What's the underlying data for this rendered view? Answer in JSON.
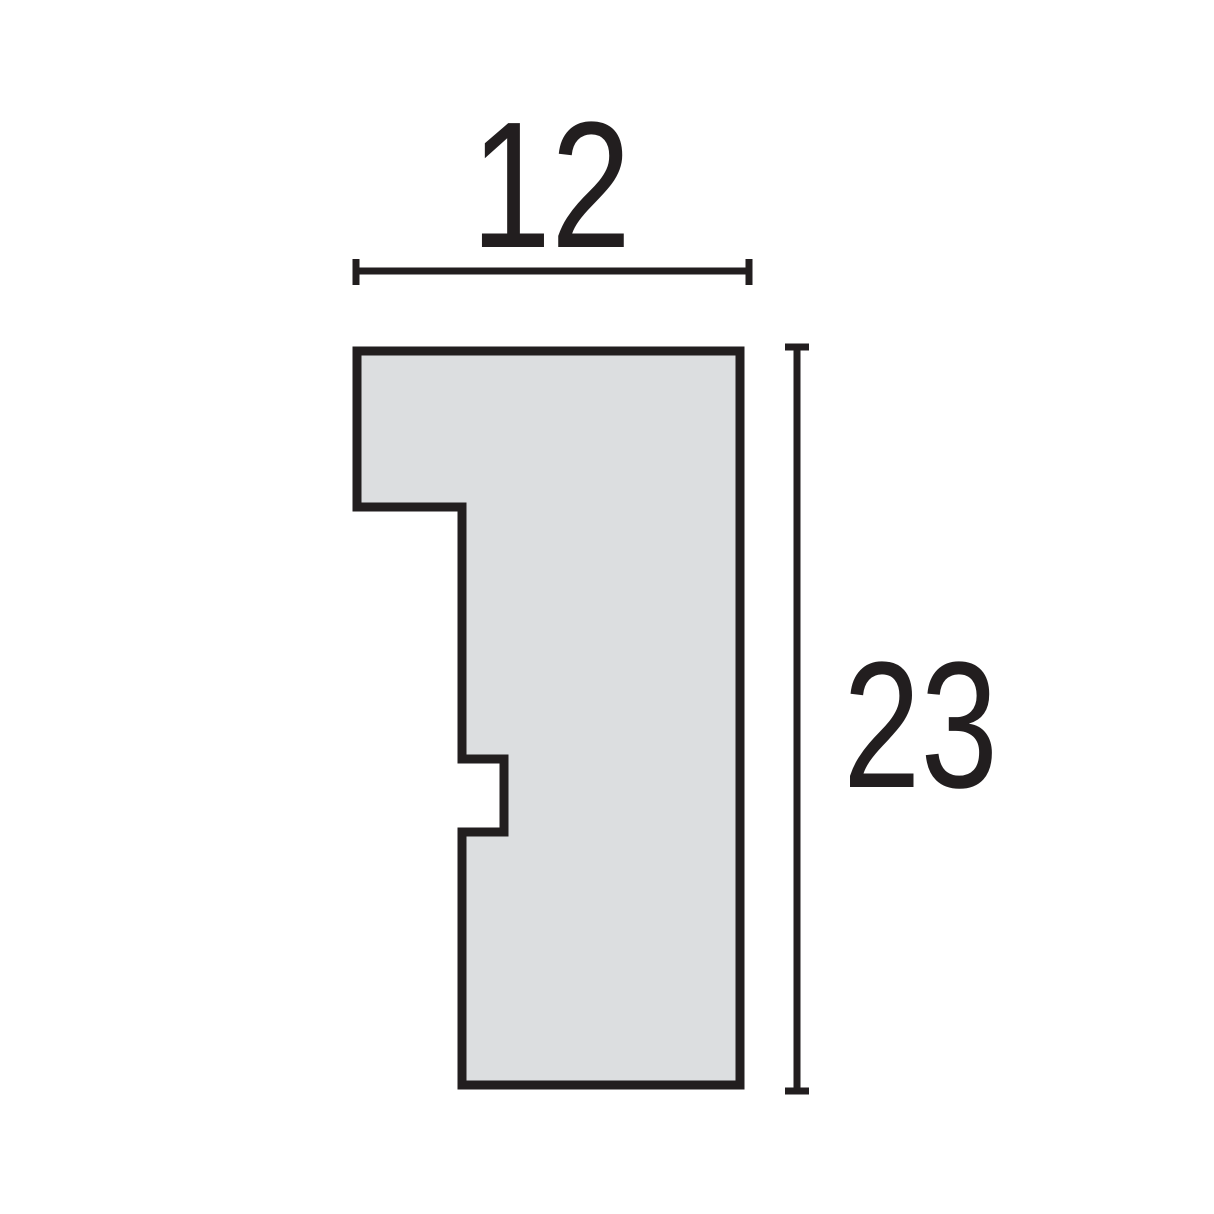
{
  "diagram": {
    "type": "profile-cross-section",
    "title": "Moulding profile cross-section with width and height dimensions",
    "profile": {
      "points": "357,351 740,351 740,1085 462,1085 462,832 504,832 504,759 462,759 462,507 357,507",
      "fill_color": "#dcdee0",
      "outline_color": "#221e1f"
    },
    "width_dimension": {
      "label": "12",
      "value": 12
    },
    "height_dimension": {
      "label": "23",
      "value": 23
    },
    "colors": {
      "background": "#ffffff",
      "dimension_lines": "#221e1f",
      "text": "#221e1f"
    }
  }
}
